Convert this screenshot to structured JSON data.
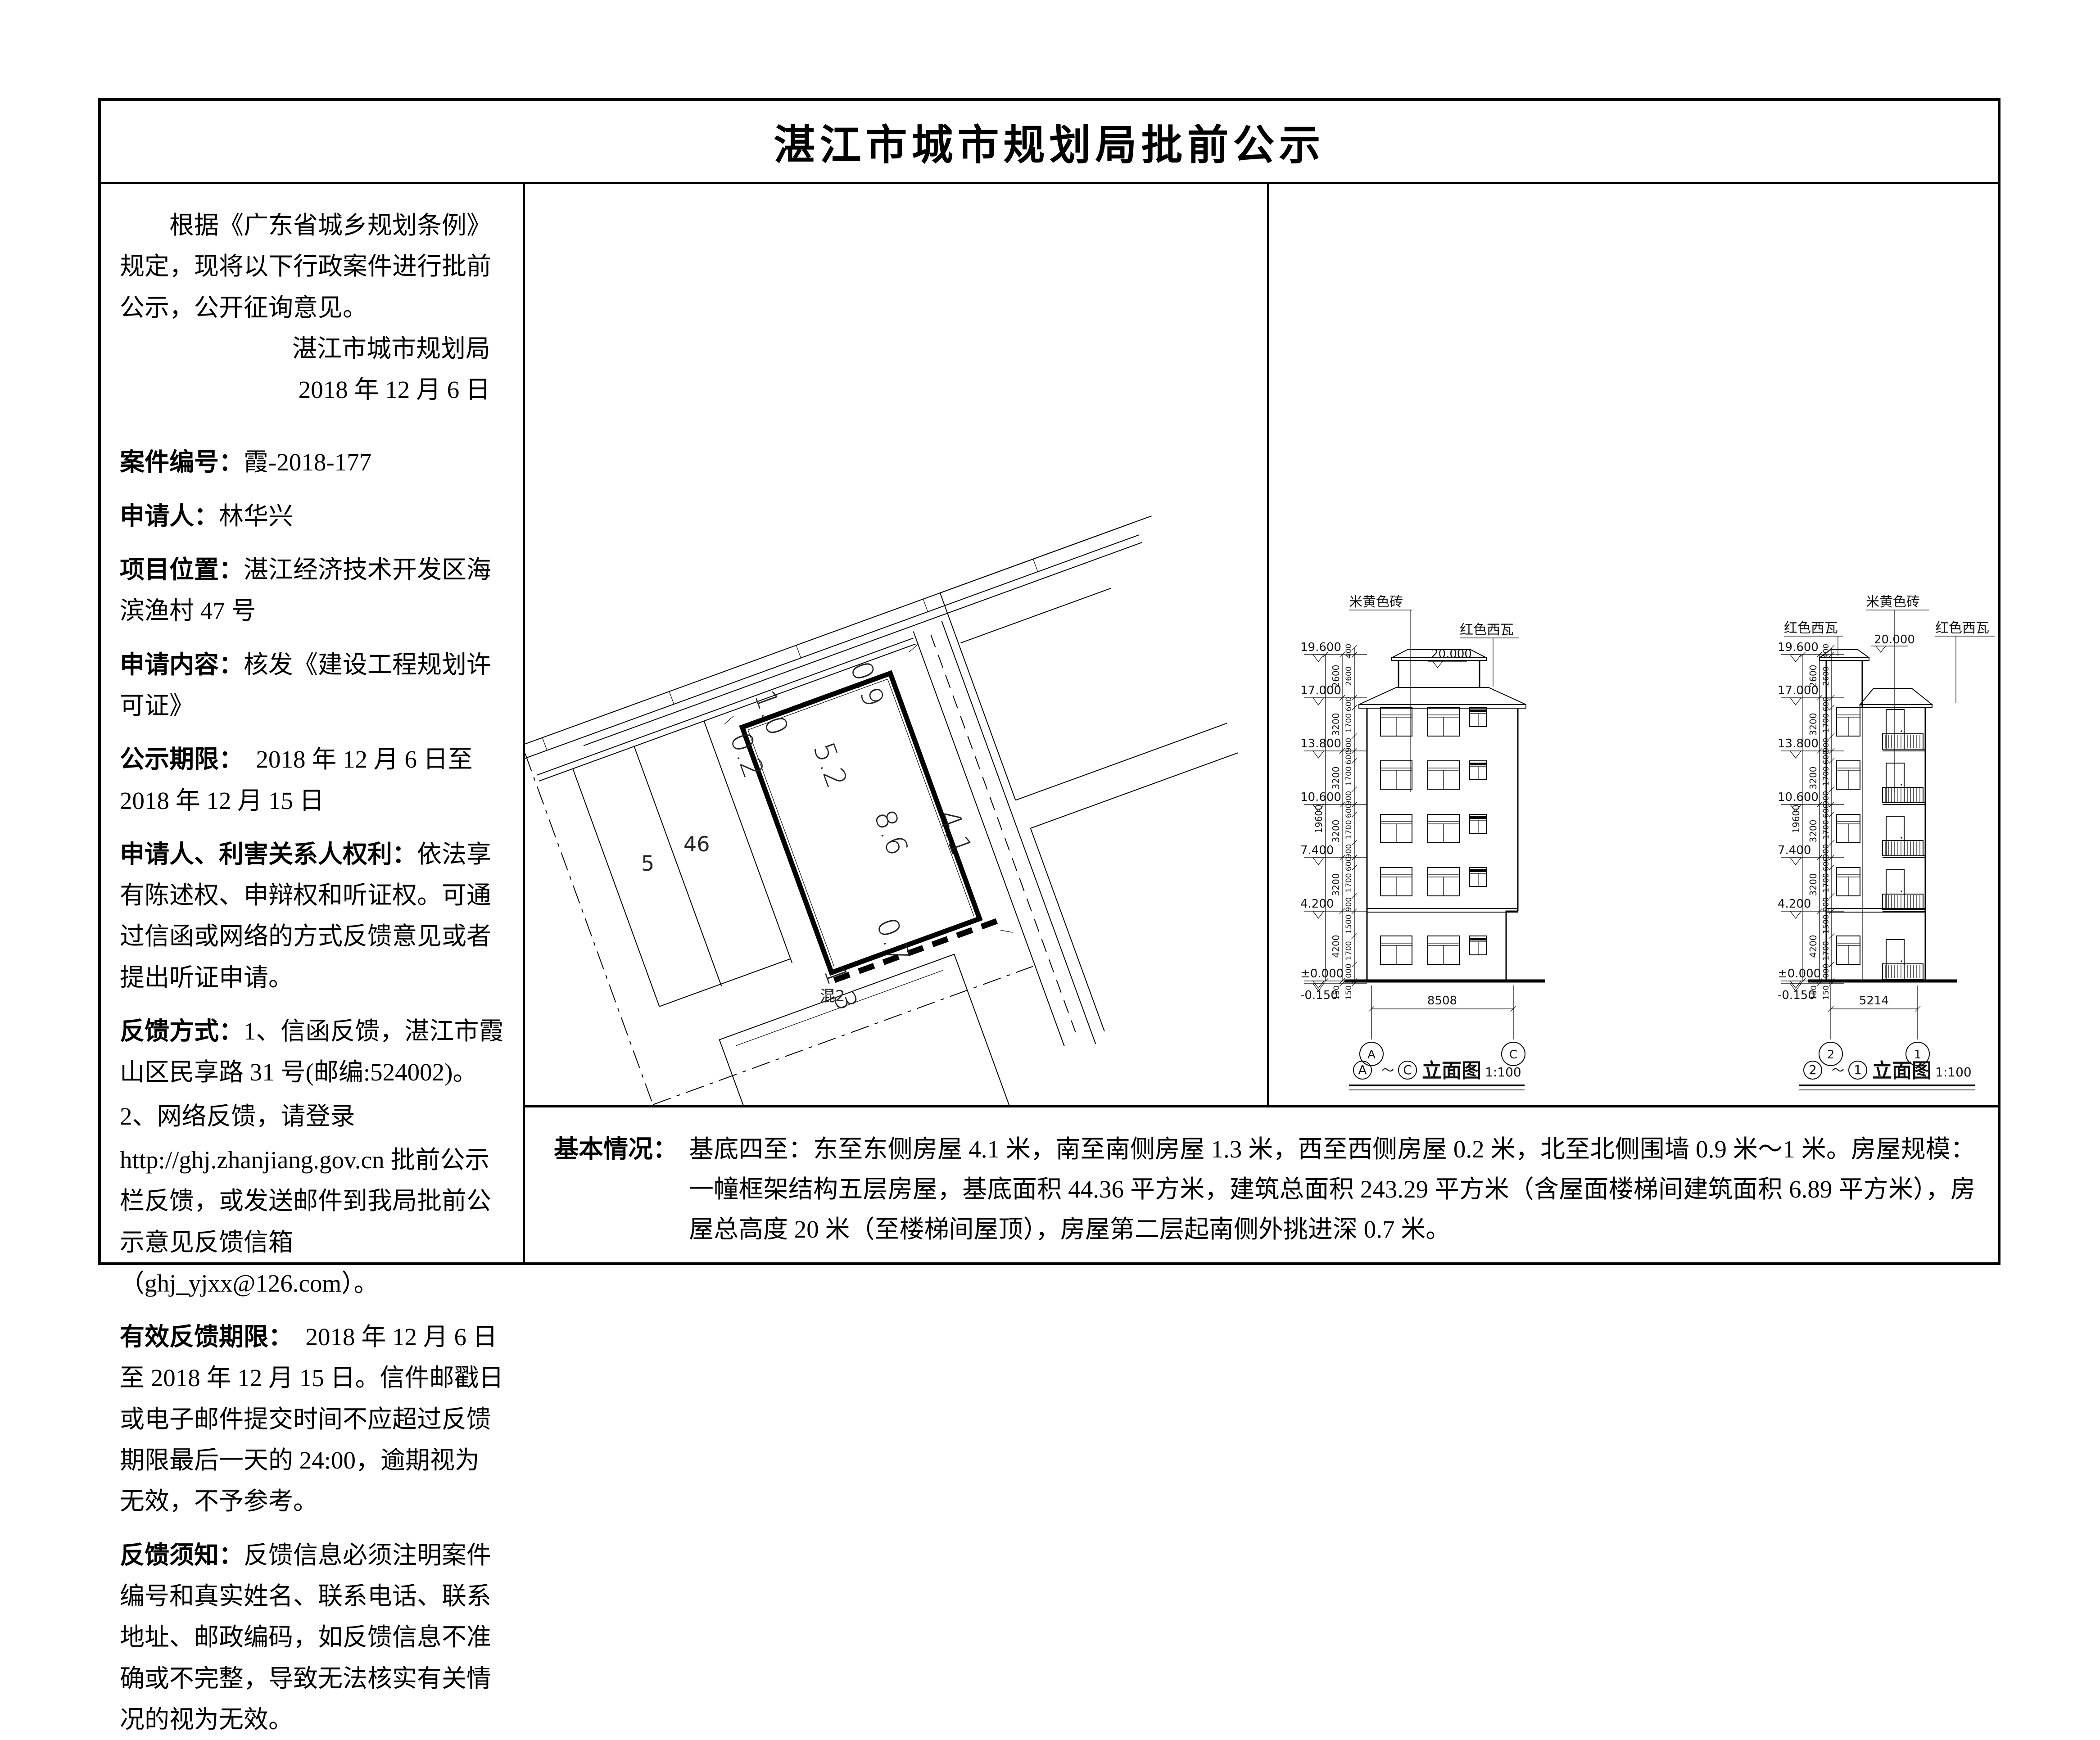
{
  "page": {
    "title": "湛江市城市规划局批前公示"
  },
  "notice": {
    "intro": "根据《广东省城乡规划条例》规定，现将以下行政案件进行批前公示，公开征询意见。",
    "authority": "湛江市城市规划局",
    "date": "2018 年 12 月 6 日",
    "items": [
      {
        "label": "案件编号：",
        "text": "霞-2018-177"
      },
      {
        "label": "申请人：",
        "text": "林华兴"
      },
      {
        "label": "项目位置：",
        "text": "湛江经济技术开发区海滨渔村 47 号"
      },
      {
        "label": "申请内容：",
        "text": "核发《建设工程规划许可证》"
      },
      {
        "label": "公示期限：",
        "text": "　2018 年 12 月 6 日至 2018 年 12 月 15 日"
      },
      {
        "label": "申请人、利害关系人权利：",
        "text": "依法享有陈述权、申辩权和听证权。可通过信函或网络的方式反馈意见或者提出听证申请。"
      },
      {
        "label": "反馈方式：",
        "text": "1、信函反馈，湛江市霞山区民享路 31 号(邮编:524002)。"
      },
      {
        "label": "",
        "text": "2、网络反馈，请登录"
      },
      {
        "label": "",
        "text": "http://ghj.zhanjiang.gov.cn 批前公示栏反馈，或发送邮件到我局批前公示意见反馈信箱（ghj_yjxx@126.com）。"
      },
      {
        "label": "有效反馈期限：",
        "text": "　2018 年 12 月 6 日至 2018 年 12 月 15 日。信件邮戳日或电子邮件提交时间不应超过反馈期限最后一天的 24:00，逾期视为无效，不予参考。"
      },
      {
        "label": "反馈须知：",
        "text": "反馈信息必须注明案件编号和真实姓名、联系电话、联系地址、邮政编码，如反馈信息不准确或不完整，导致无法核实有关情况的视为无效。"
      }
    ]
  },
  "site_plan": {
    "labels": {
      "n1": "1.0",
      "n2": "0.9",
      "w": "0.2",
      "top": "5.2",
      "e_side": "8.6",
      "e": "4.1",
      "s": "1.3",
      "s2": "0.7",
      "p1": "5",
      "p2": "46",
      "pb": "混2"
    }
  },
  "elevation_a": {
    "material_wall": "米黄色砖",
    "material_roof": "红色西瓦",
    "top_level": "20.000",
    "levels": [
      "19.600",
      "17.000",
      "13.800",
      "10.600",
      "7.400",
      "4.200",
      "±0.000",
      "-0.150"
    ],
    "total_height": "19600",
    "floor_dims": [
      "2600",
      "3200",
      "3200",
      "3200",
      "3200",
      "4200",
      "150"
    ],
    "sub_dims": [
      "400",
      "2600",
      "600",
      "1700",
      "900",
      "600",
      "1700",
      "900",
      "600",
      "1700",
      "900",
      "600",
      "1700",
      "900",
      "1500",
      "1700",
      "1000",
      "150"
    ],
    "width_dim": "8508",
    "axis_left": "A",
    "axis_right": "C",
    "tilde": "～",
    "caption": "立面图",
    "scale": "1:100"
  },
  "elevation_b": {
    "material_wall": "米黄色砖",
    "material_roof_left": "红色西瓦",
    "material_roof_right": "红色西瓦",
    "top_level": "20.000",
    "levels": [
      "19.600",
      "17.000",
      "13.800",
      "10.600",
      "7.400",
      "4.200",
      "±0.000",
      "-0.150"
    ],
    "total_height": "19600",
    "floor_dims": [
      "2600",
      "3200",
      "3200",
      "3200",
      "3200",
      "4200",
      "150"
    ],
    "sub_dims": [
      "400",
      "2600",
      "600",
      "1700",
      "900",
      "600",
      "1700",
      "900",
      "600",
      "1700",
      "900",
      "600",
      "1700",
      "900",
      "1500",
      "1700",
      "1000",
      "150"
    ],
    "width_dim": "5214",
    "axis_left": "2",
    "axis_right": "1",
    "tilde": "～",
    "caption": "立面图",
    "scale": "1:100"
  },
  "basic_info": {
    "label": "基本情况：",
    "text": "基底四至：东至东侧房屋 4.1 米，南至南侧房屋 1.3 米，西至西侧房屋 0.2 米，北至北侧围墙 0.9 米～1 米。房屋规模：一幢框架结构五层房屋，基底面积 44.36 平方米，建筑总面积 243.29 平方米（含屋面楼梯间建筑面积 6.89 平方米），房屋总高度 20 米（至楼梯间屋顶），房屋第二层起南侧外挑进深 0.7 米。"
  }
}
